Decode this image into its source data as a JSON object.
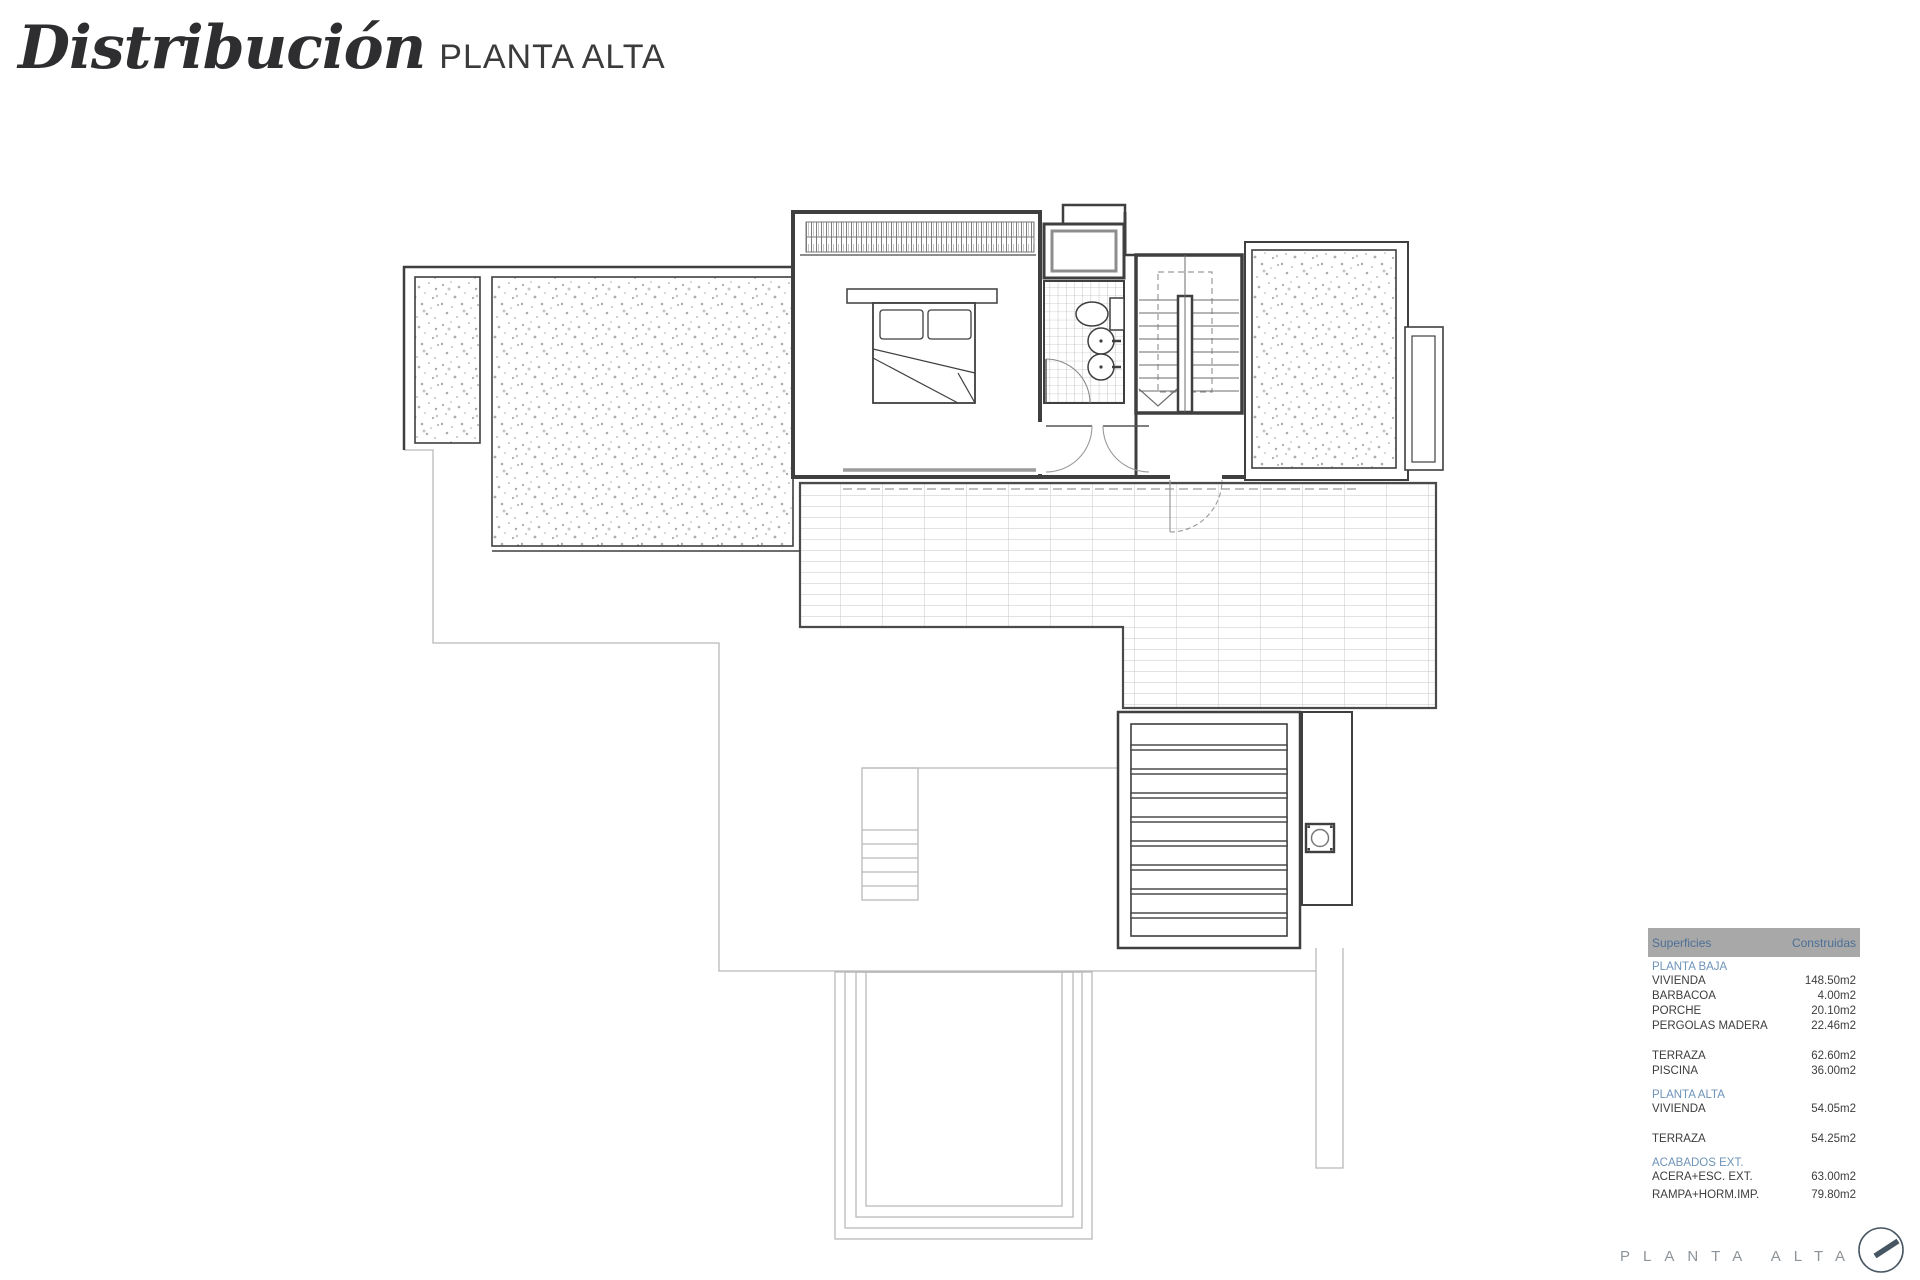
{
  "title": {
    "main": "Distribución",
    "sub": "PLANTA ALTA"
  },
  "areas_table": {
    "header": {
      "col_label": "Superficies",
      "col_value": "Construidas"
    },
    "groups": [
      {
        "label": "PLANTA BAJA",
        "rows": [
          {
            "name": "VIVIENDA",
            "value": "148.50m2"
          },
          {
            "name": "BARBACOA",
            "value": "4.00m2"
          },
          {
            "name": "PORCHE",
            "value": "20.10m2"
          },
          {
            "name": "PERGOLAS MADERA",
            "value": "22.46m2"
          },
          {
            "name": "TERRAZA",
            "value": "62.60m2",
            "gap_before": true
          },
          {
            "name": "PISCINA",
            "value": "36.00m2"
          }
        ]
      },
      {
        "label": "PLANTA ALTA",
        "rows": [
          {
            "name": "VIVIENDA",
            "value": "54.05m2"
          },
          {
            "name": "TERRAZA",
            "value": "54.25m2",
            "gap_before": true
          }
        ]
      },
      {
        "label": "ACABADOS EXT.",
        "rows": [
          {
            "name": "ACERA+ESC. EXT.",
            "value": "63.00m2"
          },
          {
            "name": "RAMPA+HORM.IMP.",
            "value": "79.80m2"
          }
        ]
      }
    ]
  },
  "footer": {
    "plan_label": "PLANTA ALTA"
  },
  "colors": {
    "table_header_bg": "#a8a8a8",
    "table_header_text": "#4c6f96",
    "group_label_text": "#6d93b8",
    "body_text": "#3d3d3d",
    "plan_dark": "#3f3f3f",
    "plan_light": "#b9b9b9",
    "footer_text": "#8d9499",
    "compass": "#475663"
  }
}
